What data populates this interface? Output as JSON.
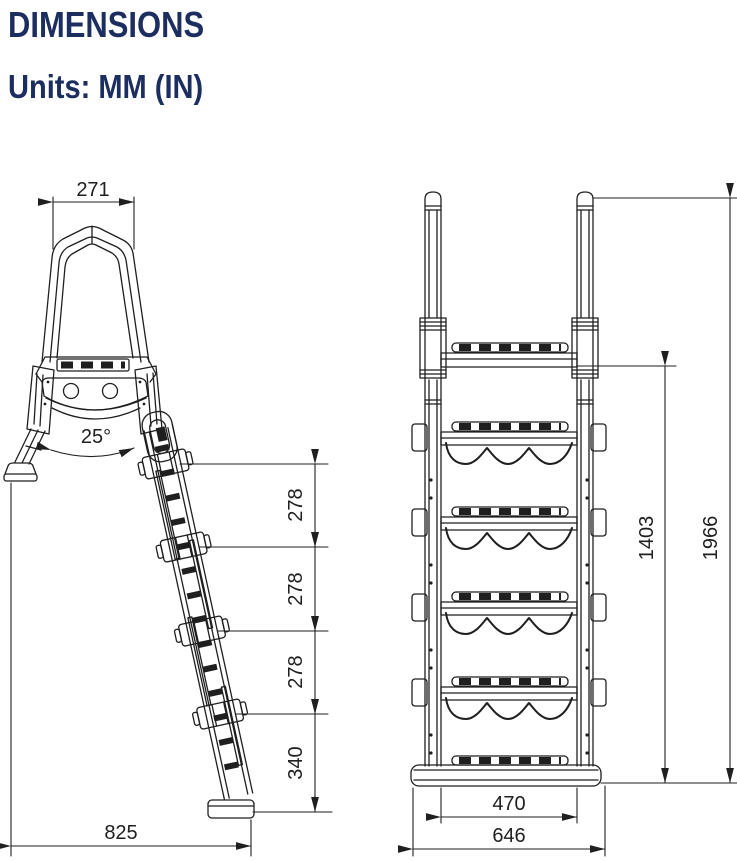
{
  "header": {
    "title": "DIMENSIONS",
    "units": "Units: MM (IN)"
  },
  "colors": {
    "title_text": "#1c2d5f",
    "line": "#1f1f1f",
    "background": "#ffffff"
  },
  "side_view": {
    "label": "side-view",
    "dimensions": {
      "handle_width": "271",
      "leg_angle": "25°",
      "segments": [
        "278",
        "278",
        "278",
        "340"
      ],
      "footprint": "825"
    }
  },
  "front_view": {
    "label": "front-view",
    "dimensions": {
      "deck_height": "1403",
      "total_height": "1966",
      "tread_width": "470",
      "base_width": "646"
    }
  }
}
